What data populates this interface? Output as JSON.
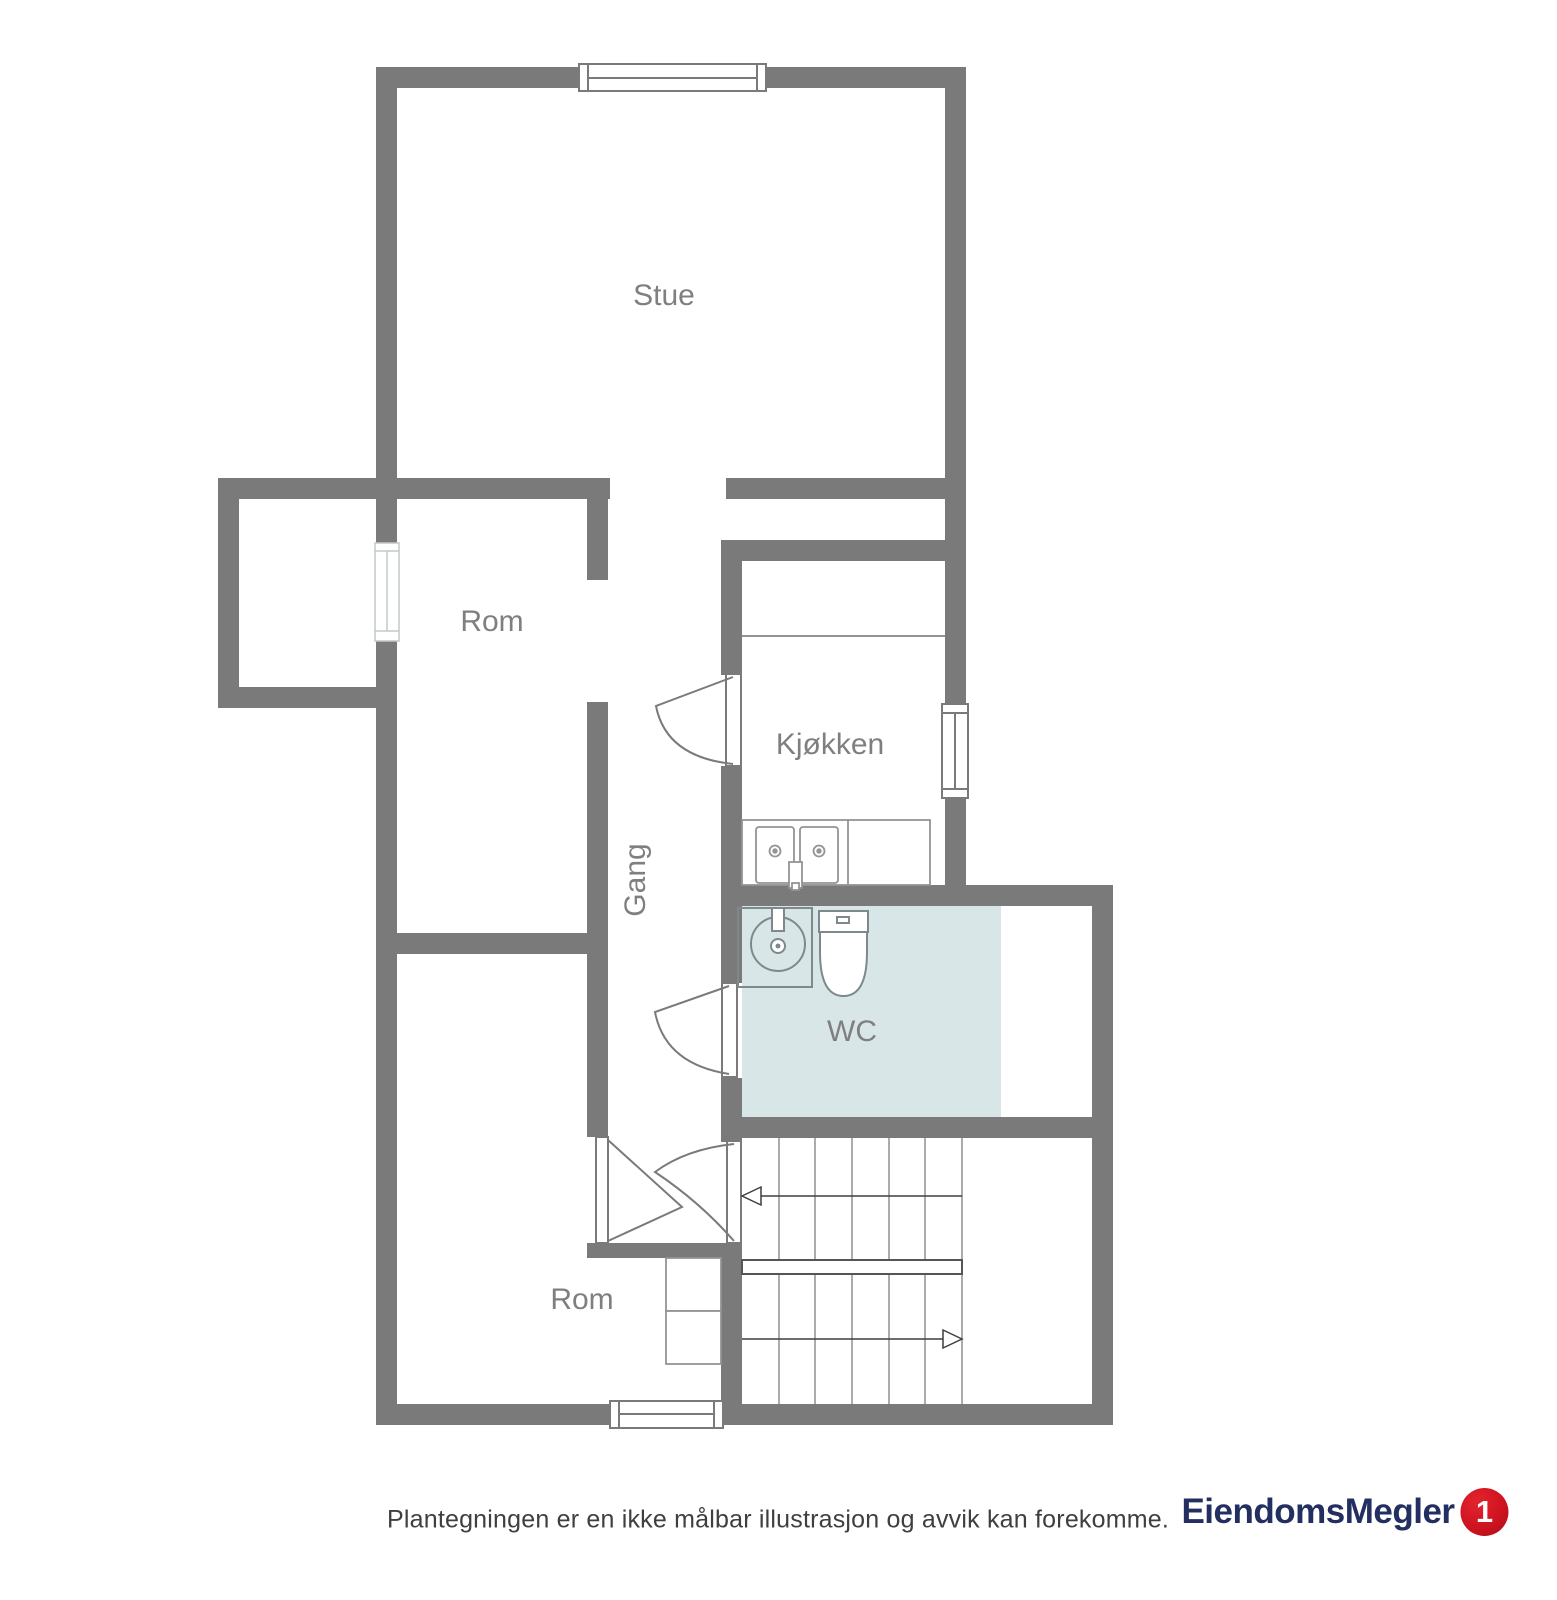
{
  "floorplan": {
    "rooms": [
      {
        "name": "stue",
        "label": "Stue"
      },
      {
        "name": "rom-upper",
        "label": "Rom"
      },
      {
        "name": "kjokken",
        "label": "Kjøkken"
      },
      {
        "name": "gang",
        "label": "Gang"
      },
      {
        "name": "wc",
        "label": "WC"
      },
      {
        "name": "rom-lower",
        "label": "Rom"
      }
    ],
    "stair_direction_arrows": [
      "left",
      "right"
    ]
  },
  "footer": {
    "disclaimer": "Plantegningen er en ikke målbar illustrasjon og avvik kan forekomme."
  },
  "logo": {
    "brand": "EiendomsMegler",
    "badge": "1"
  },
  "colors": {
    "wall": "#7a7a7a",
    "room_label": "#7f7f7f",
    "wc_floor": "#d9e6e7",
    "fixture_stroke": "#7d898c",
    "kitchen_line": "#949494",
    "stair_line": "#8f8f8f",
    "arrow": "#3f3f3f",
    "logo_navy": "#232f60",
    "logo_red": "#cf1420",
    "disclaimer_text": "#3f3f3f"
  }
}
